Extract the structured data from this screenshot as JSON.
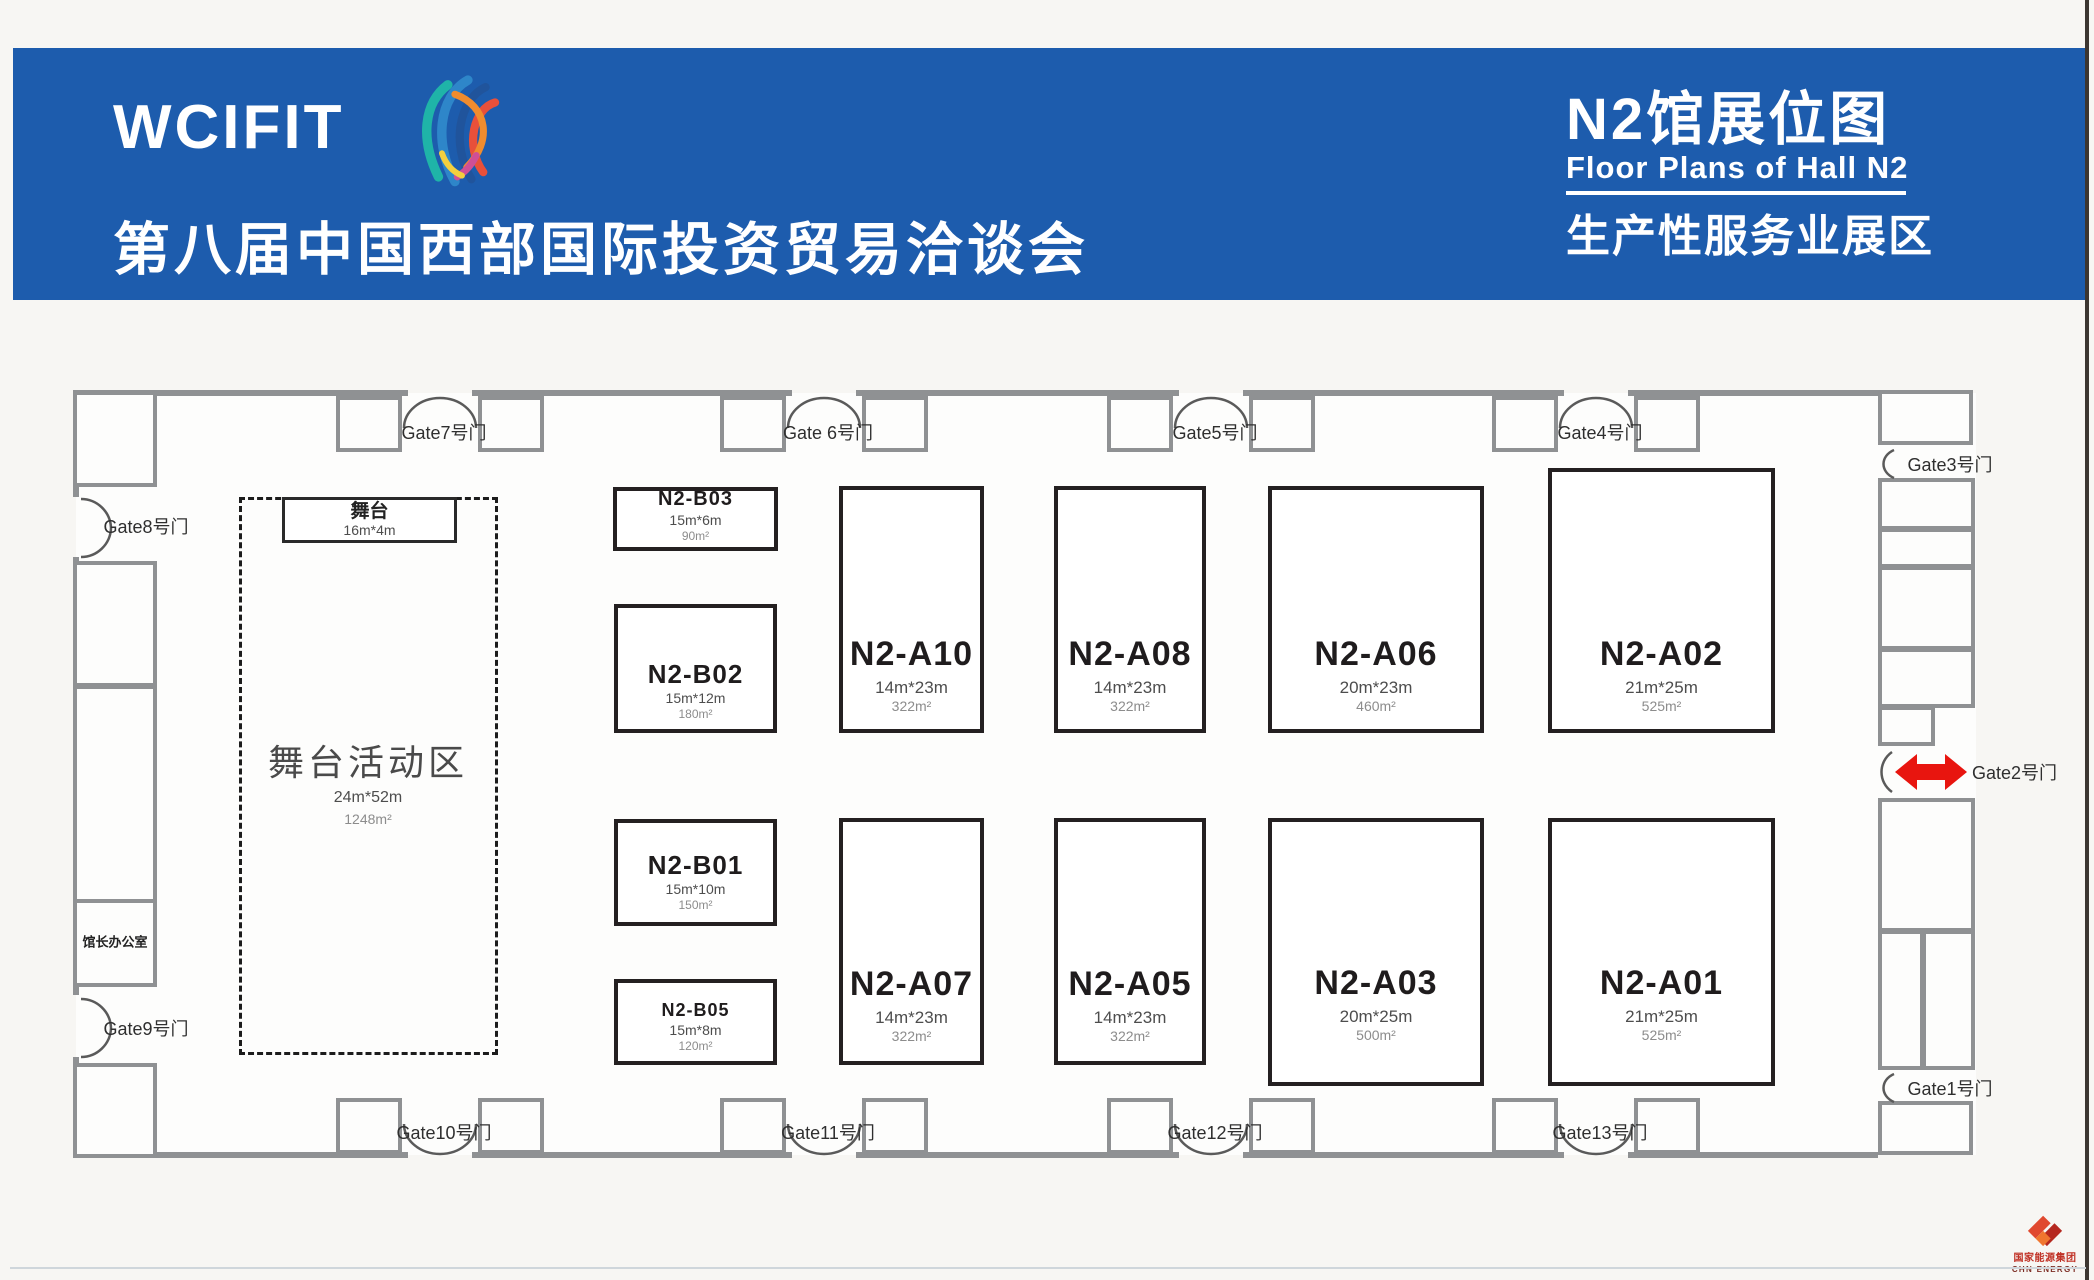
{
  "header": {
    "brand": "WCIFIT",
    "event_title": "第八届中国西部国际投资贸易洽谈会",
    "hall_title": "N2馆展位图",
    "hall_title_en": "Floor Plans of Hall N2",
    "hall_zone": "生产性服务业展区",
    "bg_color": "#1d5cad"
  },
  "stage": {
    "stage_label": "舞台",
    "stage_dims": "16m*4m",
    "zone_label": "舞台活动区",
    "zone_dims": "24m*52m",
    "zone_area": "1248m²"
  },
  "office_label": "馆长办公室",
  "booths": {
    "b03": {
      "id": "N2-B03",
      "dims": "15m*6m",
      "area": "90m²"
    },
    "b02": {
      "id": "N2-B02",
      "dims": "15m*12m",
      "area": "180m²"
    },
    "b01": {
      "id": "N2-B01",
      "dims": "15m*10m",
      "area": "150m²"
    },
    "b05": {
      "id": "N2-B05",
      "dims": "15m*8m",
      "area": "120m²"
    },
    "a10": {
      "id": "N2-A10",
      "dims": "14m*23m",
      "area": "322m²"
    },
    "a08": {
      "id": "N2-A08",
      "dims": "14m*23m",
      "area": "322m²"
    },
    "a06": {
      "id": "N2-A06",
      "dims": "20m*23m",
      "area": "460m²"
    },
    "a02": {
      "id": "N2-A02",
      "dims": "21m*25m",
      "area": "525m²"
    },
    "a07": {
      "id": "N2-A07",
      "dims": "14m*23m",
      "area": "322m²"
    },
    "a05": {
      "id": "N2-A05",
      "dims": "14m*23m",
      "area": "322m²"
    },
    "a03": {
      "id": "N2-A03",
      "dims": "20m*25m",
      "area": "500m²"
    },
    "a01": {
      "id": "N2-A01",
      "dims": "21m*25m",
      "area": "525m²"
    }
  },
  "gates": {
    "g1": "Gate1号门",
    "g2": "Gate2号门",
    "g3": "Gate3号门",
    "g4": "Gate4号门",
    "g5": "Gate5号门",
    "g6": "Gate 6号门",
    "g7": "Gate7号门",
    "g8": "Gate8号门",
    "g9": "Gate9号门",
    "g10": "Gate10号门",
    "g11": "Gate11号门",
    "g12": "Gate12号门",
    "g13": "Gate13号门"
  },
  "logo": {
    "org_cn": "国家能源集团",
    "org_en": "CHN ENERGY"
  },
  "colors": {
    "header_bg": "#1d5cad",
    "arrow_red": "#e8150f",
    "booth_border": "#242021",
    "wall_gray": "#8f9193"
  }
}
